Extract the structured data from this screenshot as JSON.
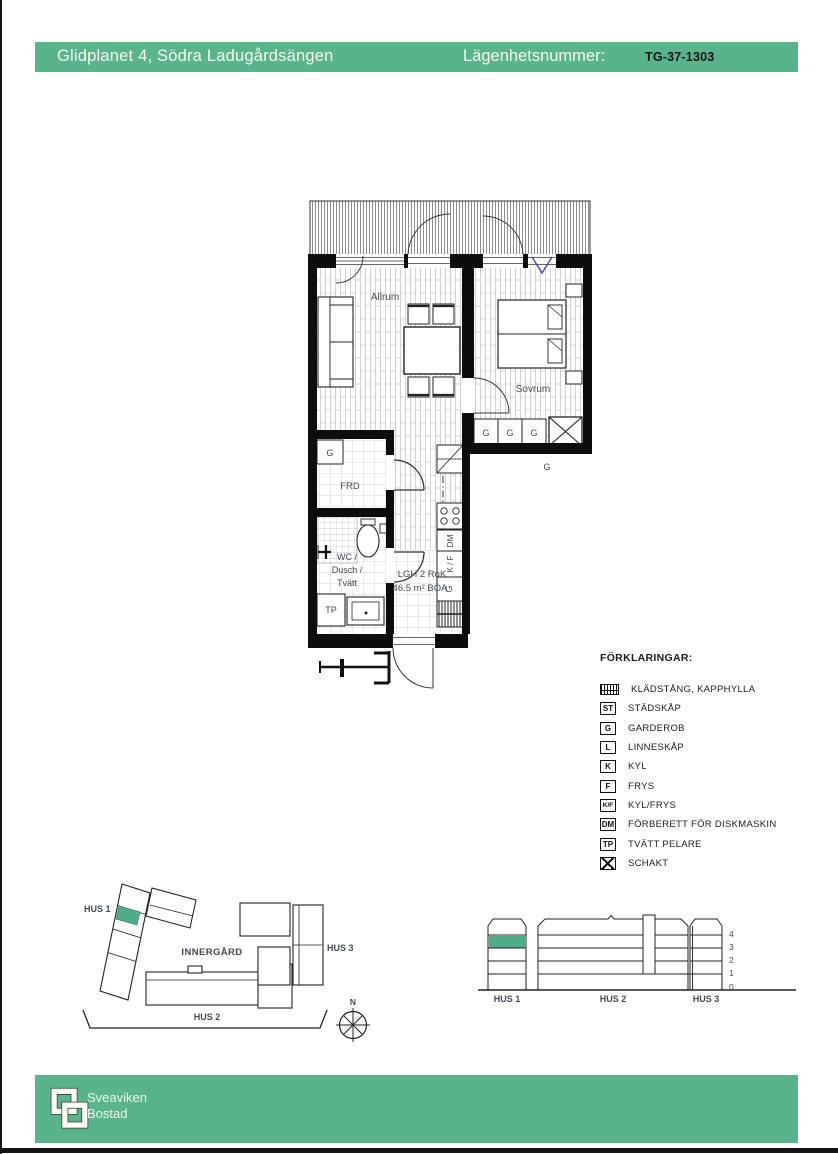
{
  "header": {
    "project": "Glidplanet 4, Södra Ladugårdsängen",
    "apartment_label": "Lägenhetsnummer:",
    "apartment_number": "TG-37-1303"
  },
  "floor_plan": {
    "room_labels": {
      "living_room": "Allrum",
      "bedroom": "Sovrum",
      "storage": "FRD",
      "bathroom": [
        "WC /",
        "Dusch /",
        "Tvätt"
      ]
    },
    "apartment_info": {
      "type": "LGH 2 RoK",
      "area": "46.5 m² BOA"
    },
    "fixture_labels": {
      "washer_tower": "TP",
      "dishwasher": "DM",
      "fridge_freezer": "K / F",
      "kitchen_wardrobe": "G",
      "storage_wardrobe": "G",
      "bedroom_closets": [
        "G",
        "G",
        "G"
      ],
      "closet_row_label": "G"
    }
  },
  "legend": {
    "title": "FÖRKLARINGAR:",
    "items": [
      {
        "symbol": "hatch",
        "label": "KLÄDSTÅNG, KAPPHYLLA"
      },
      {
        "symbol": "ST",
        "label": "STÄDSKÅP"
      },
      {
        "symbol": "G",
        "label": "GARDEROB"
      },
      {
        "symbol": "L",
        "label": "LINNESKÅP"
      },
      {
        "symbol": "K",
        "label": "KYL"
      },
      {
        "symbol": "F",
        "label": "FRYS"
      },
      {
        "symbol": "K/F",
        "label": "KYL/FRYS"
      },
      {
        "symbol": "DM",
        "label": "FÖRBERETT FÖR DISKMASKIN"
      },
      {
        "symbol": "TP",
        "label": "TVÄTT PELARE"
      },
      {
        "symbol": "schakt",
        "label": "SCHAKT"
      }
    ]
  },
  "site_plan": {
    "hus1": "HUS 1",
    "hus2": "HUS 2",
    "hus3": "HUS 3",
    "courtyard": "INNERGÅRD",
    "north": "N"
  },
  "elevation": {
    "hus1": "HUS 1",
    "hus2": "HUS 2",
    "hus3": "HUS 3",
    "floors": [
      "4",
      "3",
      "2",
      "1",
      "0"
    ]
  },
  "footer": {
    "brand_line1": "Sveaviken",
    "brand_line2": "Bostad"
  },
  "colors": {
    "green": "#59b48c",
    "highlight": "#4dae87",
    "vent_blue": "#3b3bd6"
  }
}
